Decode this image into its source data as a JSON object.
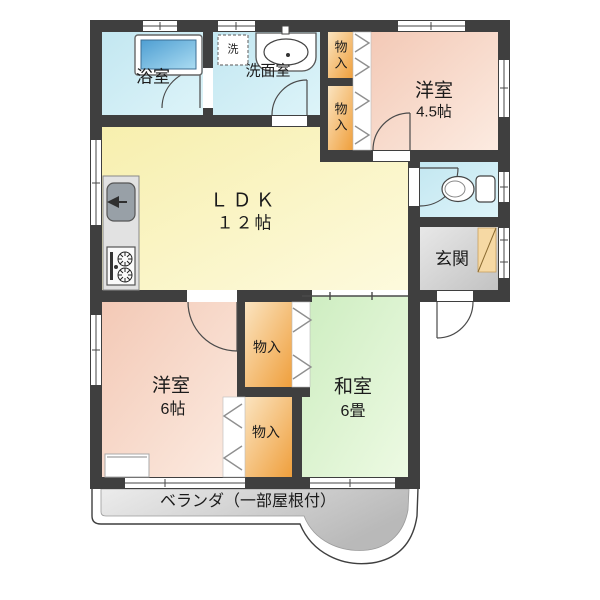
{
  "plan": {
    "bathroom": {
      "label": "浴室"
    },
    "washroom": {
      "label": "洗面室"
    },
    "laundry": {
      "label": "洗"
    },
    "closet_top_upper": {
      "label": "物入"
    },
    "closet_top_lower": {
      "label": "物入"
    },
    "western_room_45": {
      "name": "洋室",
      "size": "4.5帖"
    },
    "ldk": {
      "name": "ＬＤＫ",
      "size": "１２帖"
    },
    "entrance": {
      "label": "玄関"
    },
    "western_room_6": {
      "name": "洋室",
      "size": "6帖"
    },
    "closet_mid": {
      "label": "物入"
    },
    "closet_low": {
      "label": "物入"
    },
    "japanese_room": {
      "name": "和室",
      "size": "6畳"
    },
    "veranda": {
      "label": "ベランダ（一部屋根付）"
    }
  },
  "colors": {
    "wall": "#3f3f3f",
    "water_rooms": "#cdeaf3",
    "western_room": "#f6d0bf",
    "ldk": "#f9f2ba",
    "japanese_room": "#d7f0c8",
    "closet": "#f2a747",
    "entrance_floor": "#d6d6d6",
    "veranda": "#cfcfcf",
    "tub": "#5ba5d6",
    "shoe_cabinet": "#f6d9a4"
  }
}
